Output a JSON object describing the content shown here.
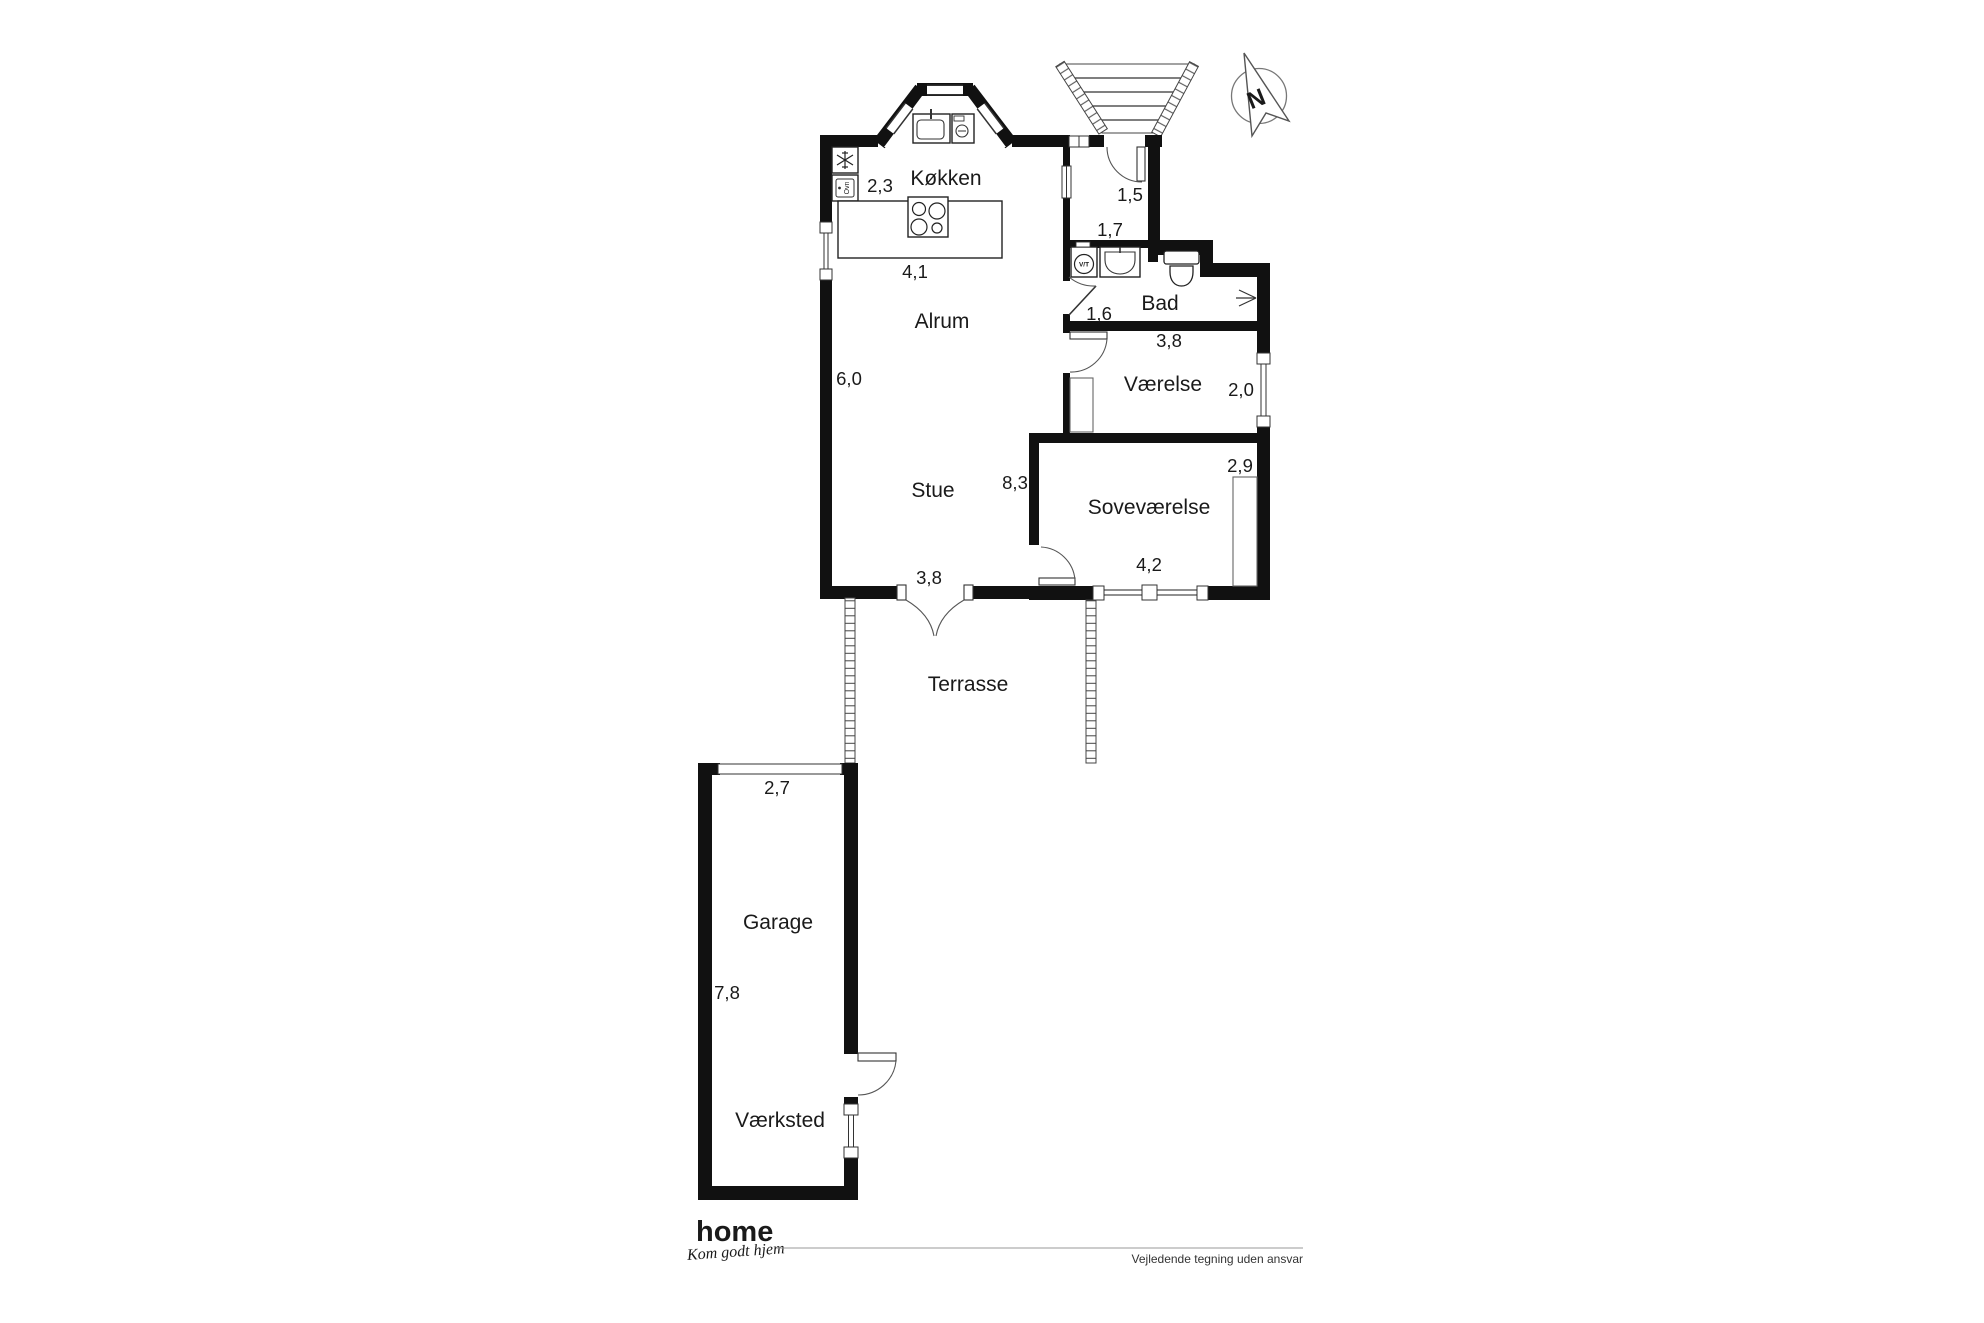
{
  "rooms": {
    "kokken": {
      "label": "Køkken"
    },
    "alrum": {
      "label": "Alrum"
    },
    "stue": {
      "label": "Stue"
    },
    "bad": {
      "label": "Bad"
    },
    "vaerelse": {
      "label": "Værelse"
    },
    "sovevaerelse": {
      "label": "Soveværelse"
    },
    "terrasse": {
      "label": "Terrasse"
    },
    "garage": {
      "label": "Garage"
    },
    "vaerksted": {
      "label": "Værksted"
    }
  },
  "dimensions": {
    "kokken_w": "2,3",
    "island_w": "4,1",
    "alrum_h": "6,0",
    "stue_w": "3,8",
    "stue_h": "8,3",
    "entre_w": "1,5",
    "entre_h": "1,7",
    "bad_h": "1,6",
    "vaerelse_w": "3,8",
    "vaerelse_h": "2,0",
    "sove_w": "4,2",
    "sove_h": "2,9",
    "garage_w": "2,7",
    "garage_h": "7,8"
  },
  "appliances": {
    "oven_label": "Ovn",
    "washer_label": "V/T"
  },
  "compass": {
    "north": "N"
  },
  "footer": {
    "brand": "home",
    "tagline": "Kom godt hjem",
    "disclaimer": "Vejledende tegning uden ansvar"
  },
  "colors": {
    "wall": "#111111",
    "brand_red": "#e2001a"
  }
}
